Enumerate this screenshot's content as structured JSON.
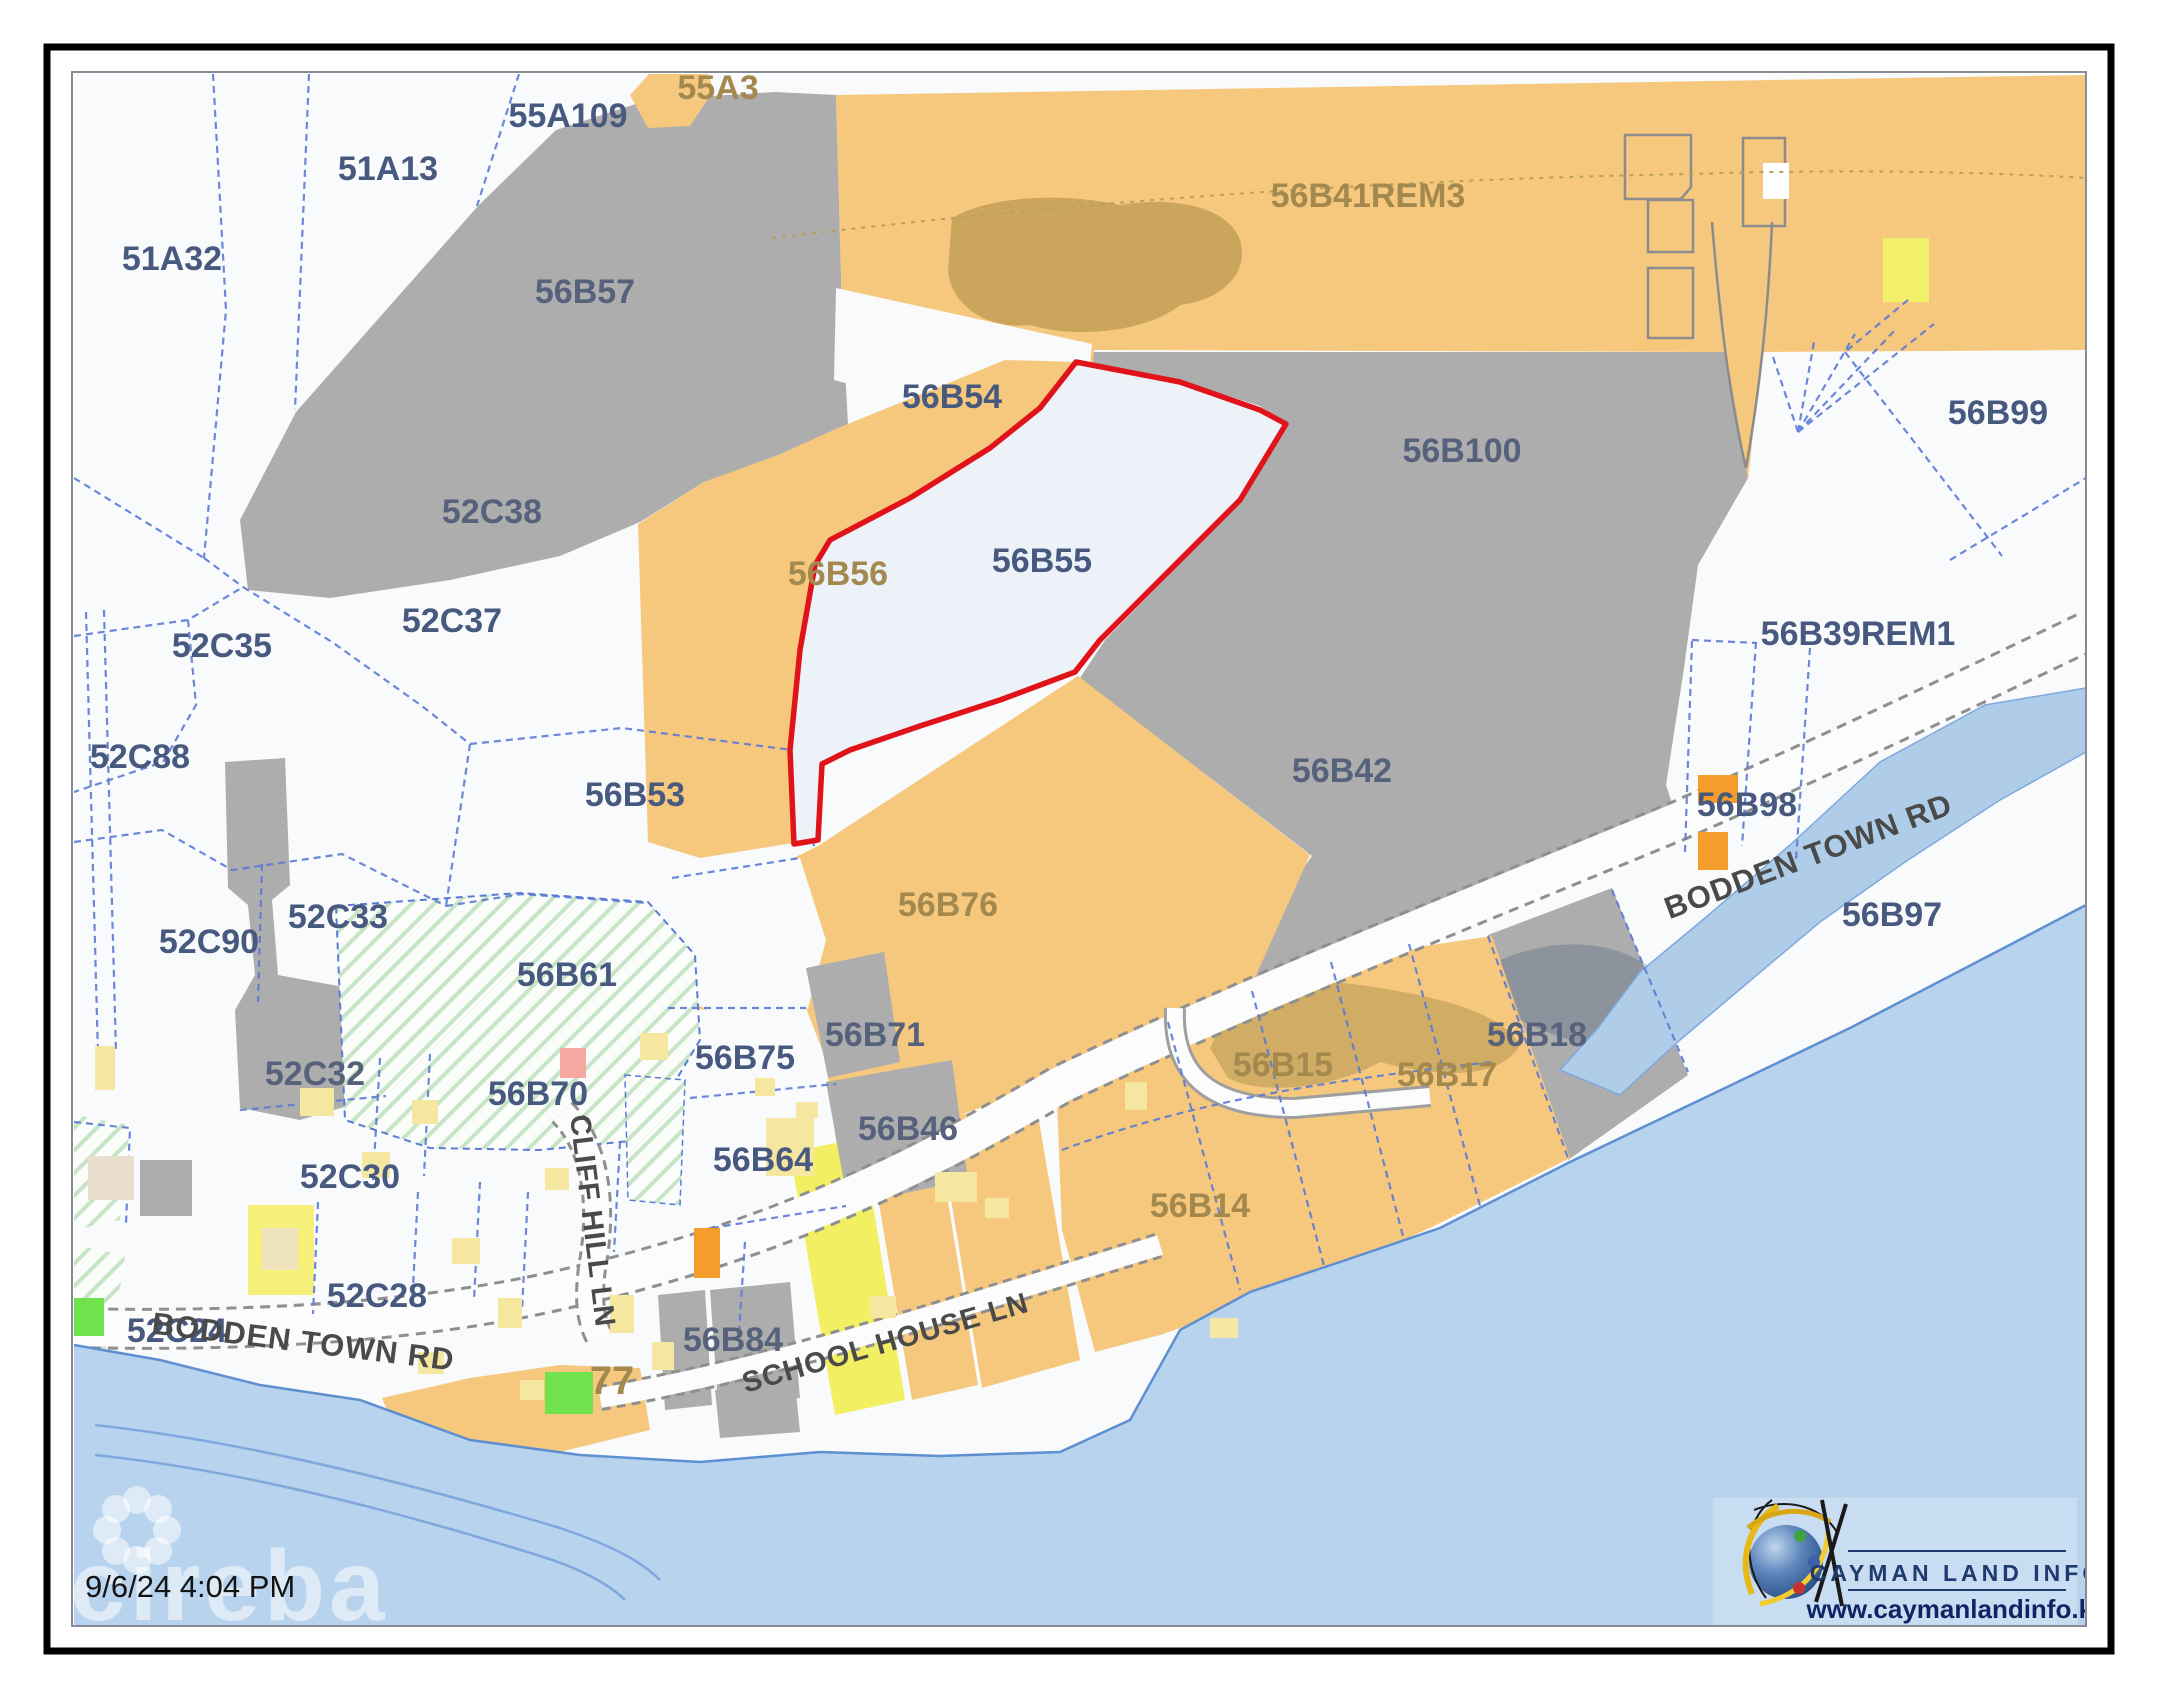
{
  "map": {
    "timestamp": "9/6/24 4:04 PM",
    "watermark": "cireba",
    "logo": {
      "title": "CAYMAN LAND INFO",
      "url": "www.caymanlandinfo.ky"
    },
    "palette": {
      "blue": "#47597F",
      "gray": "#56617C",
      "olive": "#A3894E",
      "road": "#4A4A4A",
      "parcel_orange": "#F6C87E",
      "parcel_gray": "#ADADAD",
      "water": "#B7D3ED",
      "highlight_outline": "#E0131A",
      "boundary_blue": "#5B7BD5"
    },
    "parcel_labels": [
      {
        "id": "51A32",
        "text": "51A32",
        "x": 172,
        "y": 270,
        "fill": "blue",
        "size": 34
      },
      {
        "id": "51A13",
        "text": "51A13",
        "x": 388,
        "y": 180,
        "fill": "blue",
        "size": 34
      },
      {
        "id": "55A109",
        "text": "55A109",
        "x": 568,
        "y": 127,
        "fill": "blue",
        "size": 34
      },
      {
        "id": "55A3",
        "text": "55A3",
        "x": 718,
        "y": 99,
        "fill": "olive",
        "size": 34
      },
      {
        "id": "56B57",
        "text": "56B57",
        "x": 585,
        "y": 303,
        "fill": "gray",
        "size": 34
      },
      {
        "id": "56B41REM3",
        "text": "56B41REM3",
        "x": 1368,
        "y": 207,
        "fill": "olive",
        "size": 34
      },
      {
        "id": "56B54",
        "text": "56B54",
        "x": 952,
        "y": 408,
        "fill": "blue",
        "size": 34
      },
      {
        "id": "56B100",
        "text": "56B100",
        "x": 1462,
        "y": 462,
        "fill": "gray",
        "size": 34
      },
      {
        "id": "56B99",
        "text": "56B99",
        "x": 1998,
        "y": 424,
        "fill": "blue",
        "size": 34
      },
      {
        "id": "52C38",
        "text": "52C38",
        "x": 492,
        "y": 523,
        "fill": "gray",
        "size": 34
      },
      {
        "id": "56B56",
        "text": "56B56",
        "x": 838,
        "y": 585,
        "fill": "olive",
        "size": 34
      },
      {
        "id": "52C37",
        "text": "52C37",
        "x": 452,
        "y": 632,
        "fill": "blue",
        "size": 34
      },
      {
        "id": "52C35",
        "text": "52C35",
        "x": 222,
        "y": 657,
        "fill": "blue",
        "size": 34
      },
      {
        "id": "56B55",
        "text": "56B55",
        "x": 1042,
        "y": 572,
        "fill": "blue",
        "size": 34
      },
      {
        "id": "56B39REM1",
        "text": "56B39REM1",
        "x": 1858,
        "y": 645,
        "fill": "blue",
        "size": 34
      },
      {
        "id": "52C88",
        "text": "52C88",
        "x": 140,
        "y": 768,
        "fill": "blue",
        "size": 34
      },
      {
        "id": "56B53",
        "text": "56B53",
        "x": 635,
        "y": 806,
        "fill": "blue",
        "size": 34
      },
      {
        "id": "56B42",
        "text": "56B42",
        "x": 1342,
        "y": 782,
        "fill": "gray",
        "size": 34
      },
      {
        "id": "56B98",
        "text": "56B98",
        "x": 1747,
        "y": 816,
        "fill": "blue",
        "size": 34
      },
      {
        "id": "52C33",
        "text": "52C33",
        "x": 338,
        "y": 928,
        "fill": "blue",
        "size": 34
      },
      {
        "id": "56B97",
        "text": "56B97",
        "x": 1892,
        "y": 926,
        "fill": "blue",
        "size": 34
      },
      {
        "id": "52C90",
        "text": "52C90",
        "x": 209,
        "y": 953,
        "fill": "blue",
        "size": 34
      },
      {
        "id": "56B76",
        "text": "56B76",
        "x": 948,
        "y": 916,
        "fill": "olive",
        "size": 34
      },
      {
        "id": "56B61",
        "text": "56B61",
        "x": 567,
        "y": 986,
        "fill": "blue",
        "size": 34
      },
      {
        "id": "52C32",
        "text": "52C32",
        "x": 315,
        "y": 1085,
        "fill": "gray",
        "size": 34
      },
      {
        "id": "56B71",
        "text": "56B71",
        "x": 875,
        "y": 1046,
        "fill": "gray",
        "size": 34
      },
      {
        "id": "56B75",
        "text": "56B75",
        "x": 745,
        "y": 1069,
        "fill": "blue",
        "size": 34
      },
      {
        "id": "56B15",
        "text": "56B15",
        "x": 1283,
        "y": 1076,
        "fill": "olive",
        "size": 34
      },
      {
        "id": "56B17",
        "text": "56B17",
        "x": 1447,
        "y": 1086,
        "fill": "olive",
        "size": 34
      },
      {
        "id": "56B18",
        "text": "56B18",
        "x": 1537,
        "y": 1046,
        "fill": "gray",
        "size": 34
      },
      {
        "id": "56B70",
        "text": "56B70",
        "x": 538,
        "y": 1105,
        "fill": "blue",
        "size": 34
      },
      {
        "id": "56B64",
        "text": "56B64",
        "x": 763,
        "y": 1171,
        "fill": "blue",
        "size": 34
      },
      {
        "id": "56B46",
        "text": "56B46",
        "x": 908,
        "y": 1140,
        "fill": "gray",
        "size": 34
      },
      {
        "id": "52C30",
        "text": "52C30",
        "x": 350,
        "y": 1188,
        "fill": "blue",
        "size": 34
      },
      {
        "id": "56B14",
        "text": "56B14",
        "x": 1200,
        "y": 1217,
        "fill": "olive",
        "size": 34
      },
      {
        "id": "52C28",
        "text": "52C28",
        "x": 377,
        "y": 1307,
        "fill": "blue",
        "size": 34
      },
      {
        "id": "52C24",
        "text": "52C24",
        "x": 177,
        "y": 1342,
        "fill": "blue",
        "size": 34
      },
      {
        "id": "56B84",
        "text": "56B84",
        "x": 733,
        "y": 1351,
        "fill": "gray",
        "size": 34
      },
      {
        "id": "77",
        "text": "77",
        "x": 612,
        "y": 1394,
        "fill": "olive",
        "size": 40
      }
    ],
    "road_labels": [
      {
        "id": "bodden-town-rd-west",
        "text": "BODDEN TOWN RD",
        "x": 302,
        "y": 1352,
        "rot": 7,
        "size": 31
      },
      {
        "id": "bodden-town-rd-east",
        "text": "BODDEN TOWN RD",
        "x": 1812,
        "y": 866,
        "rot": -20.5,
        "size": 31
      },
      {
        "id": "school-house-ln",
        "text": "SCHOOL HOUSE LN",
        "x": 888,
        "y": 1352,
        "rot": -16,
        "size": 29
      },
      {
        "id": "cliff-hill-ln",
        "text": "CLIFF HILL LN",
        "x": 583,
        "y": 1222,
        "rot": 83,
        "size": 29
      }
    ]
  }
}
